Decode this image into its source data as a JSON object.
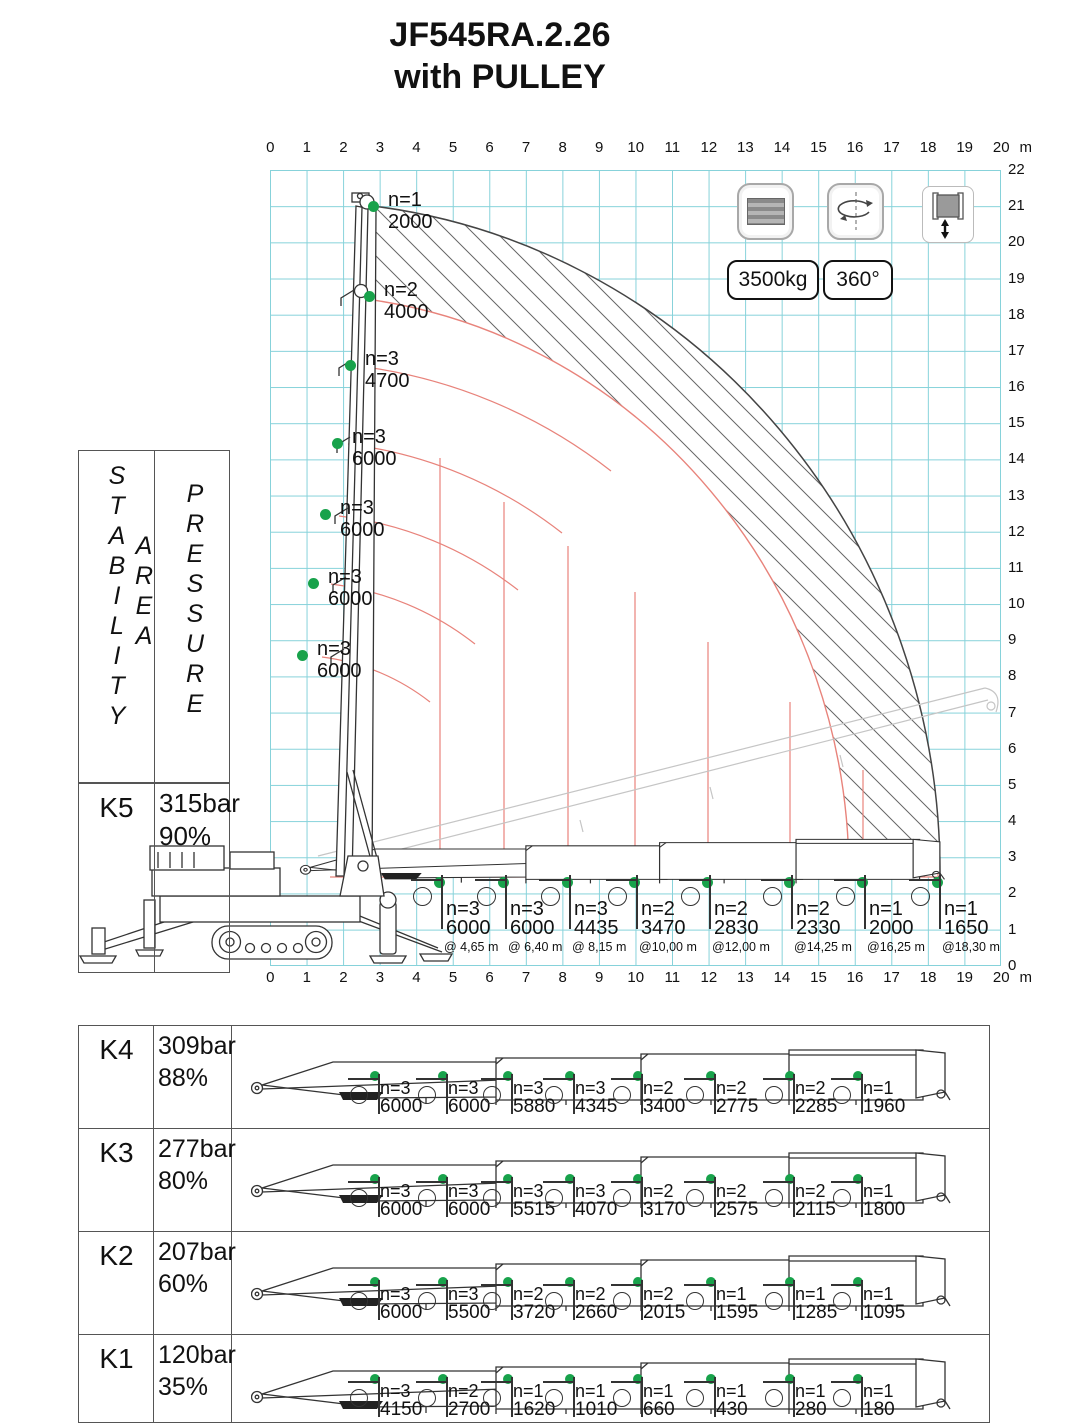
{
  "title": {
    "line1": "JF545RA.2.26",
    "line2": "with PULLEY"
  },
  "legend": {
    "capacity": "3500kg",
    "rotation": "360°"
  },
  "icons": {
    "counterweight": "stacked-plates",
    "rotation": "ellipse-with-arrows",
    "winch": "cable-spool-up-down",
    "pulley": "circle-sheave",
    "load_point": "green-dot"
  },
  "axes": {
    "x_ticks": [
      "0",
      "1",
      "2",
      "3",
      "4",
      "5",
      "6",
      "7",
      "8",
      "9",
      "10",
      "11",
      "12",
      "13",
      "14",
      "15",
      "16",
      "17",
      "18",
      "19",
      "20"
    ],
    "unit": "m",
    "y_ticks": [
      "22",
      "21",
      "20",
      "19",
      "18",
      "17",
      "16",
      "15",
      "14",
      "13",
      "12",
      "11",
      "10",
      "9",
      "8",
      "7",
      "6",
      "5",
      "4",
      "3",
      "2",
      "1",
      "0"
    ]
  },
  "stability_header": {
    "col1": "STABILITY",
    "col1b": "AREA",
    "col2": "PRESSURE"
  },
  "chart_data": {
    "type": "crane-load-envelope",
    "model": "JF545RA.2.26 with PULLEY",
    "x_axis_range_m": [
      0,
      20
    ],
    "y_axis_range_m": [
      0,
      22
    ],
    "max_capacity": "3500kg",
    "slew_range": "360°",
    "stability_class": "K5",
    "pressure": "315bar",
    "percent": "90%",
    "boom_vertical_points": [
      {
        "n": "n=1",
        "load": "2000",
        "height_m": 21.0,
        "px": 103,
        "py": 36
      },
      {
        "n": "n=2",
        "load": "4000",
        "height_m": 18.5,
        "px": 99,
        "py": 126
      },
      {
        "n": "n=3",
        "load": "4700",
        "height_m": 16.6,
        "px": 80,
        "py": 195
      },
      {
        "n": "n=3",
        "load": "6000",
        "height_m": 14.4,
        "px": 67,
        "py": 273
      },
      {
        "n": "n=3",
        "load": "6000",
        "height_m": 12.5,
        "px": 55,
        "py": 344
      },
      {
        "n": "n=3",
        "load": "6000",
        "height_m": 10.6,
        "px": 43,
        "py": 413
      },
      {
        "n": "n=3",
        "load": "6000",
        "height_m": 8.6,
        "px": 32,
        "py": 485
      }
    ],
    "boom_horizontal_points": [
      {
        "n": "n=3",
        "load": "6000",
        "radius": "@ 4,65 m",
        "radius_m": 4.65,
        "px": 170
      },
      {
        "n": "n=3",
        "load": "6000",
        "radius": "@ 6,40 m",
        "radius_m": 6.4,
        "px": 234
      },
      {
        "n": "n=3",
        "load": "4435",
        "radius": "@ 8,15 m",
        "radius_m": 8.15,
        "px": 298
      },
      {
        "n": "n=2",
        "load": "3470",
        "radius": "@10,00 m",
        "radius_m": 10.0,
        "px": 365
      },
      {
        "n": "n=2",
        "load": "2830",
        "radius": "@12,00 m",
        "radius_m": 12.0,
        "px": 438
      },
      {
        "n": "n=2",
        "load": "2330",
        "radius": "@14,25 m",
        "radius_m": 14.25,
        "px": 520
      },
      {
        "n": "n=1",
        "load": "2000",
        "radius": "@16,25 m",
        "radius_m": 16.25,
        "px": 593
      },
      {
        "n": "n=1",
        "load": "1650",
        "radius": "@18,30 m",
        "radius_m": 18.3,
        "px": 668
      }
    ]
  },
  "k5_row": {
    "k": "K5",
    "pressure": "315bar",
    "percent": "90%"
  },
  "k_rows": [
    {
      "k": "K4",
      "pressure": "309bar",
      "percent": "88%",
      "loads": [
        {
          "n": "n=3",
          "load": "6000",
          "px": 299
        },
        {
          "n": "n=3",
          "load": "6000",
          "px": 367
        },
        {
          "n": "n=3",
          "load": "5880",
          "px": 432
        },
        {
          "n": "n=3",
          "load": "4345",
          "px": 494
        },
        {
          "n": "n=2",
          "load": "3400",
          "px": 562
        },
        {
          "n": "n=2",
          "load": "2775",
          "px": 635
        },
        {
          "n": "n=2",
          "load": "2285",
          "px": 714
        },
        {
          "n": "n=1",
          "load": "1960",
          "px": 782
        }
      ]
    },
    {
      "k": "K3",
      "pressure": "277bar",
      "percent": "80%",
      "loads": [
        {
          "n": "n=3",
          "load": "6000",
          "px": 299
        },
        {
          "n": "n=3",
          "load": "6000",
          "px": 367
        },
        {
          "n": "n=3",
          "load": "5515",
          "px": 432
        },
        {
          "n": "n=3",
          "load": "4070",
          "px": 494
        },
        {
          "n": "n=2",
          "load": "3170",
          "px": 562
        },
        {
          "n": "n=2",
          "load": "2575",
          "px": 635
        },
        {
          "n": "n=2",
          "load": "2115",
          "px": 714
        },
        {
          "n": "n=1",
          "load": "1800",
          "px": 782
        }
      ]
    },
    {
      "k": "K2",
      "pressure": "207bar",
      "percent": "60%",
      "loads": [
        {
          "n": "n=3",
          "load": "6000",
          "px": 299
        },
        {
          "n": "n=3",
          "load": "5500",
          "px": 367
        },
        {
          "n": "n=2",
          "load": "3720",
          "px": 432
        },
        {
          "n": "n=2",
          "load": "2660",
          "px": 494
        },
        {
          "n": "n=2",
          "load": "2015",
          "px": 562
        },
        {
          "n": "n=1",
          "load": "1595",
          "px": 635
        },
        {
          "n": "n=1",
          "load": "1285",
          "px": 714
        },
        {
          "n": "n=1",
          "load": "1095",
          "px": 782
        }
      ]
    },
    {
      "k": "K1",
      "pressure": "120bar",
      "percent": "35%",
      "loads": [
        {
          "n": "n=3",
          "load": "4150",
          "px": 299
        },
        {
          "n": "n=2",
          "load": "2700",
          "px": 367
        },
        {
          "n": "n=1",
          "load": "1620",
          "px": 432
        },
        {
          "n": "n=1",
          "load": "1010",
          "px": 494
        },
        {
          "n": "n=1",
          "load": "660",
          "px": 562
        },
        {
          "n": "n=1",
          "load": "430",
          "px": 635
        },
        {
          "n": "n=1",
          "load": "280",
          "px": 714
        },
        {
          "n": "n=1",
          "load": "180",
          "px": 782
        }
      ]
    }
  ],
  "colors": {
    "grid": "#86d2da",
    "envelope_red": "#e8837b",
    "point_green": "#18a24b",
    "line": "#3a3a3a"
  }
}
